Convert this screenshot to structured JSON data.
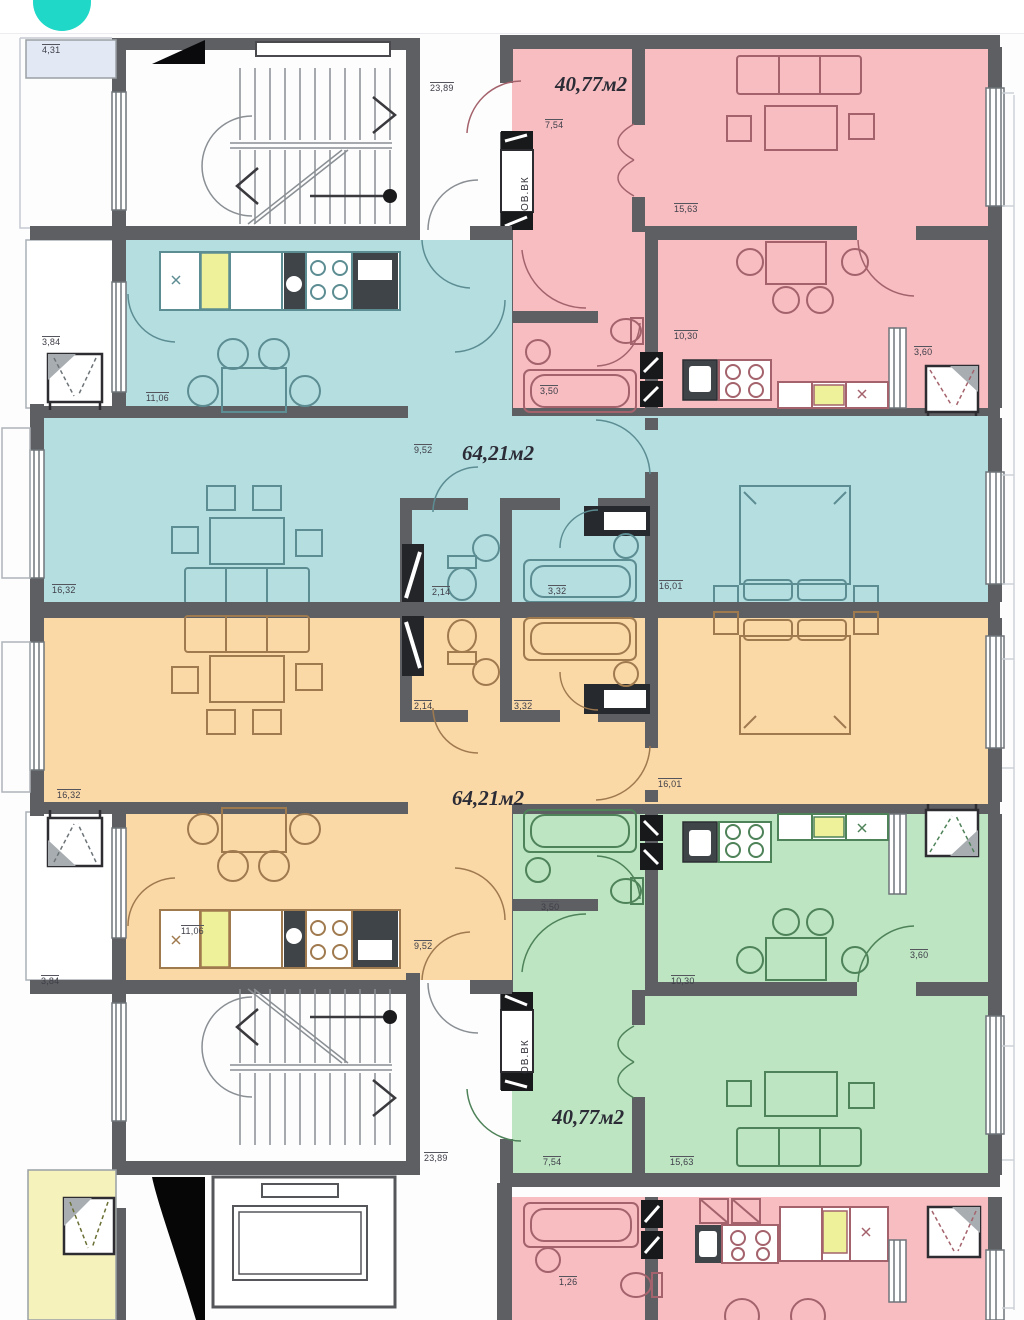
{
  "app": {
    "accent_circle": "teal-circle-logo"
  },
  "plan": {
    "type": "residential-floor-plan",
    "apartments": [
      {
        "name": "apartment-top-right",
        "area": "40,77м2",
        "color_key": "pink"
      },
      {
        "name": "apartment-middle-upper",
        "area": "64,21м2",
        "color_key": "teal"
      },
      {
        "name": "apartment-middle-lower",
        "area": "64,21м2",
        "color_key": "orange"
      },
      {
        "name": "apartment-bottom-right",
        "area": "40,77м2",
        "color_key": "green"
      },
      {
        "name": "apartment-bottom-partial",
        "area": "",
        "color_key": "pink"
      }
    ],
    "colors": {
      "accent": "#1fd8c8",
      "wall": "#5e5f63",
      "pink": "#f7bdc1",
      "teal": "#b5dee0",
      "orange": "#fbd9a7",
      "green": "#bde5c2",
      "yellow": "#f6f2bb",
      "balcony_blue": "#e2e9f4",
      "counter_yellow": "#eef09a",
      "shaft_dark": "#232528",
      "furn_pink": "#a4636c",
      "furn_teal": "#5c8d93",
      "furn_orange": "#a07a4f",
      "furn_green": "#4e8258"
    },
    "labels": [
      {
        "id": "balcony-top-left",
        "text": "4,31"
      },
      {
        "id": "corridor-top",
        "text": "23,89"
      },
      {
        "id": "apt-pink-area",
        "text": "40,77м2"
      },
      {
        "id": "apt-pink-hall",
        "text": "7,54"
      },
      {
        "id": "apt-pink-living",
        "text": "15,63"
      },
      {
        "id": "shaft-top",
        "text": "ОВ.ВК"
      },
      {
        "id": "apt-pink-bath",
        "text": "3,50"
      },
      {
        "id": "apt-pink-kitchen",
        "text": "10,30"
      },
      {
        "id": "apt-pink-balcony",
        "text": "3,60"
      },
      {
        "id": "apt-teal-balcony",
        "text": "3,84"
      },
      {
        "id": "apt-teal-kitchen",
        "text": "11,06"
      },
      {
        "id": "apt-teal-hall",
        "text": "9,52"
      },
      {
        "id": "apt-teal-area",
        "text": "64,21м2"
      },
      {
        "id": "apt-teal-living",
        "text": "16,32"
      },
      {
        "id": "apt-teal-wc",
        "text": "2,14"
      },
      {
        "id": "apt-teal-bath",
        "text": "3,32"
      },
      {
        "id": "apt-teal-bedroom",
        "text": "16,01"
      },
      {
        "id": "apt-orange-living",
        "text": "16,32"
      },
      {
        "id": "apt-orange-wc",
        "text": "2,14"
      },
      {
        "id": "apt-orange-bath",
        "text": "3,32"
      },
      {
        "id": "apt-orange-bedroom",
        "text": "16,01"
      },
      {
        "id": "apt-orange-area",
        "text": "64,21м2"
      },
      {
        "id": "apt-orange-kitchen",
        "text": "11,06"
      },
      {
        "id": "apt-orange-hall",
        "text": "9,52"
      },
      {
        "id": "apt-orange-balcony",
        "text": "3,84"
      },
      {
        "id": "apt-green-bath",
        "text": "3,50"
      },
      {
        "id": "apt-green-kitchen",
        "text": "10,30"
      },
      {
        "id": "apt-green-balcony",
        "text": "3,60"
      },
      {
        "id": "shaft-bottom",
        "text": "ОВ.ВК"
      },
      {
        "id": "apt-green-area",
        "text": "40,77м2"
      },
      {
        "id": "apt-green-hall",
        "text": "7,54"
      },
      {
        "id": "apt-green-living",
        "text": "15,63"
      },
      {
        "id": "corridor-bottom",
        "text": "23,89"
      },
      {
        "id": "apt-pink2-bath",
        "text": "1,26"
      }
    ]
  }
}
